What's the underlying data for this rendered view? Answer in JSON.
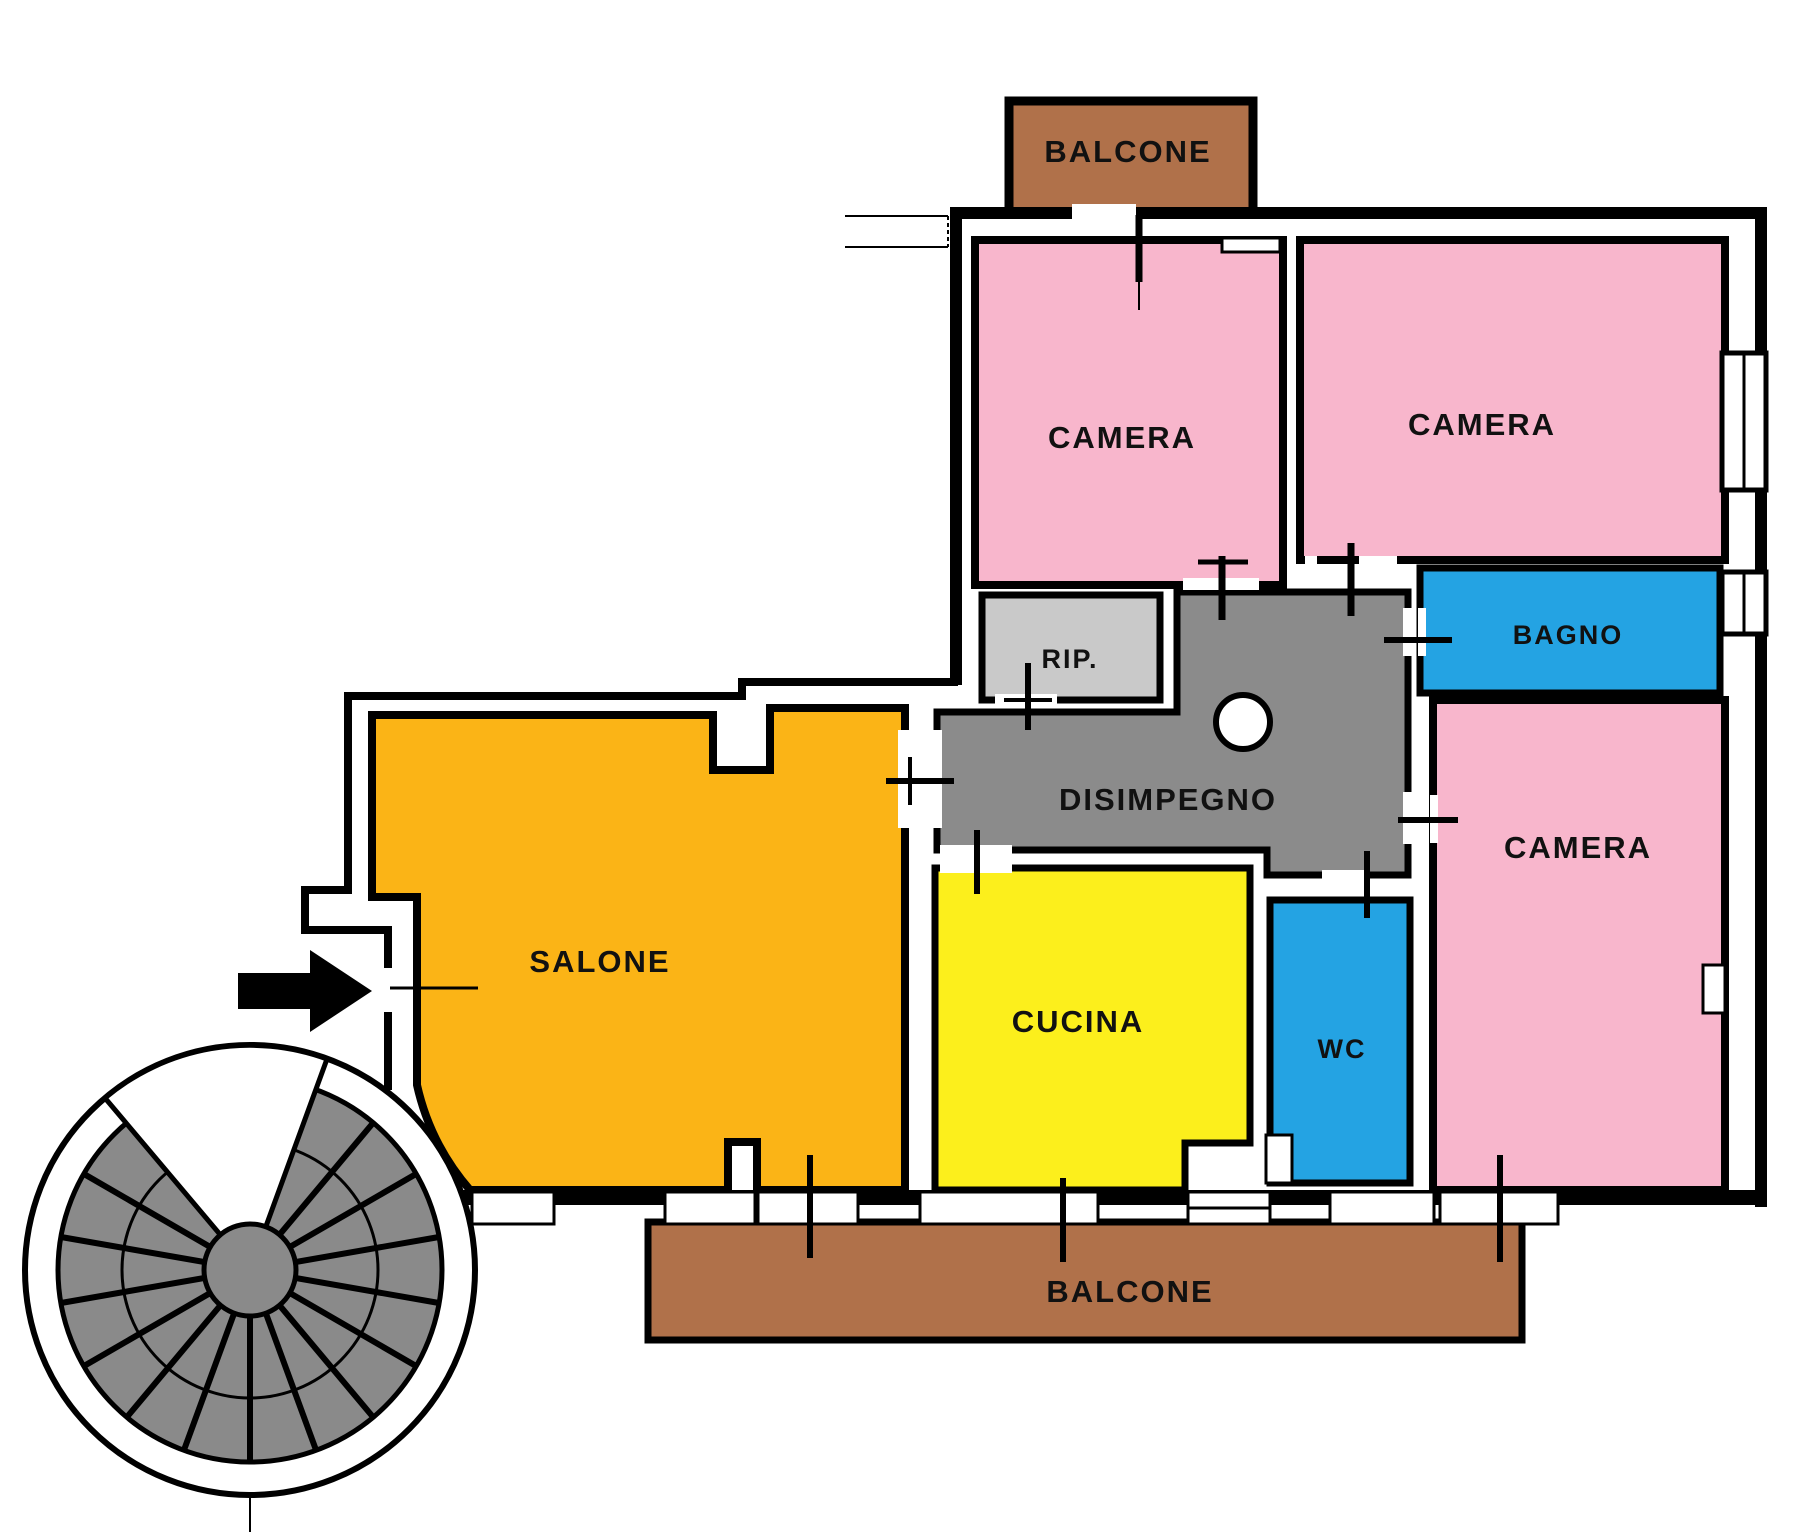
{
  "plan": {
    "type": "apartment-floor-plan",
    "rooms": {
      "balcone_top": {
        "label": "BALCONE",
        "color": "#B0714A"
      },
      "camera_nw": {
        "label": "CAMERA",
        "color": "#F8B6CC"
      },
      "camera_ne": {
        "label": "CAMERA",
        "color": "#F8B6CC"
      },
      "rip": {
        "label": "RIP.",
        "color": "#C9C9C9"
      },
      "bagno": {
        "label": "BAGNO",
        "color": "#24A3E3"
      },
      "disimpegno": {
        "label": "DISIMPEGNO",
        "color": "#8B8B8B"
      },
      "salone": {
        "label": "SALONE",
        "color": "#FBB416"
      },
      "cucina": {
        "label": "CUCINA",
        "color": "#FCEF1C"
      },
      "wc": {
        "label": "WC",
        "color": "#24A3E3"
      },
      "camera_se": {
        "label": "CAMERA",
        "color": "#F8B6CC"
      },
      "balcone_bottom": {
        "label": "BALCONE",
        "color": "#B0714A"
      }
    },
    "stair": {
      "name": "spiral-staircase",
      "color": "#8A8A8A"
    },
    "wall_color": "#000000",
    "background": "#FFFFFF"
  }
}
